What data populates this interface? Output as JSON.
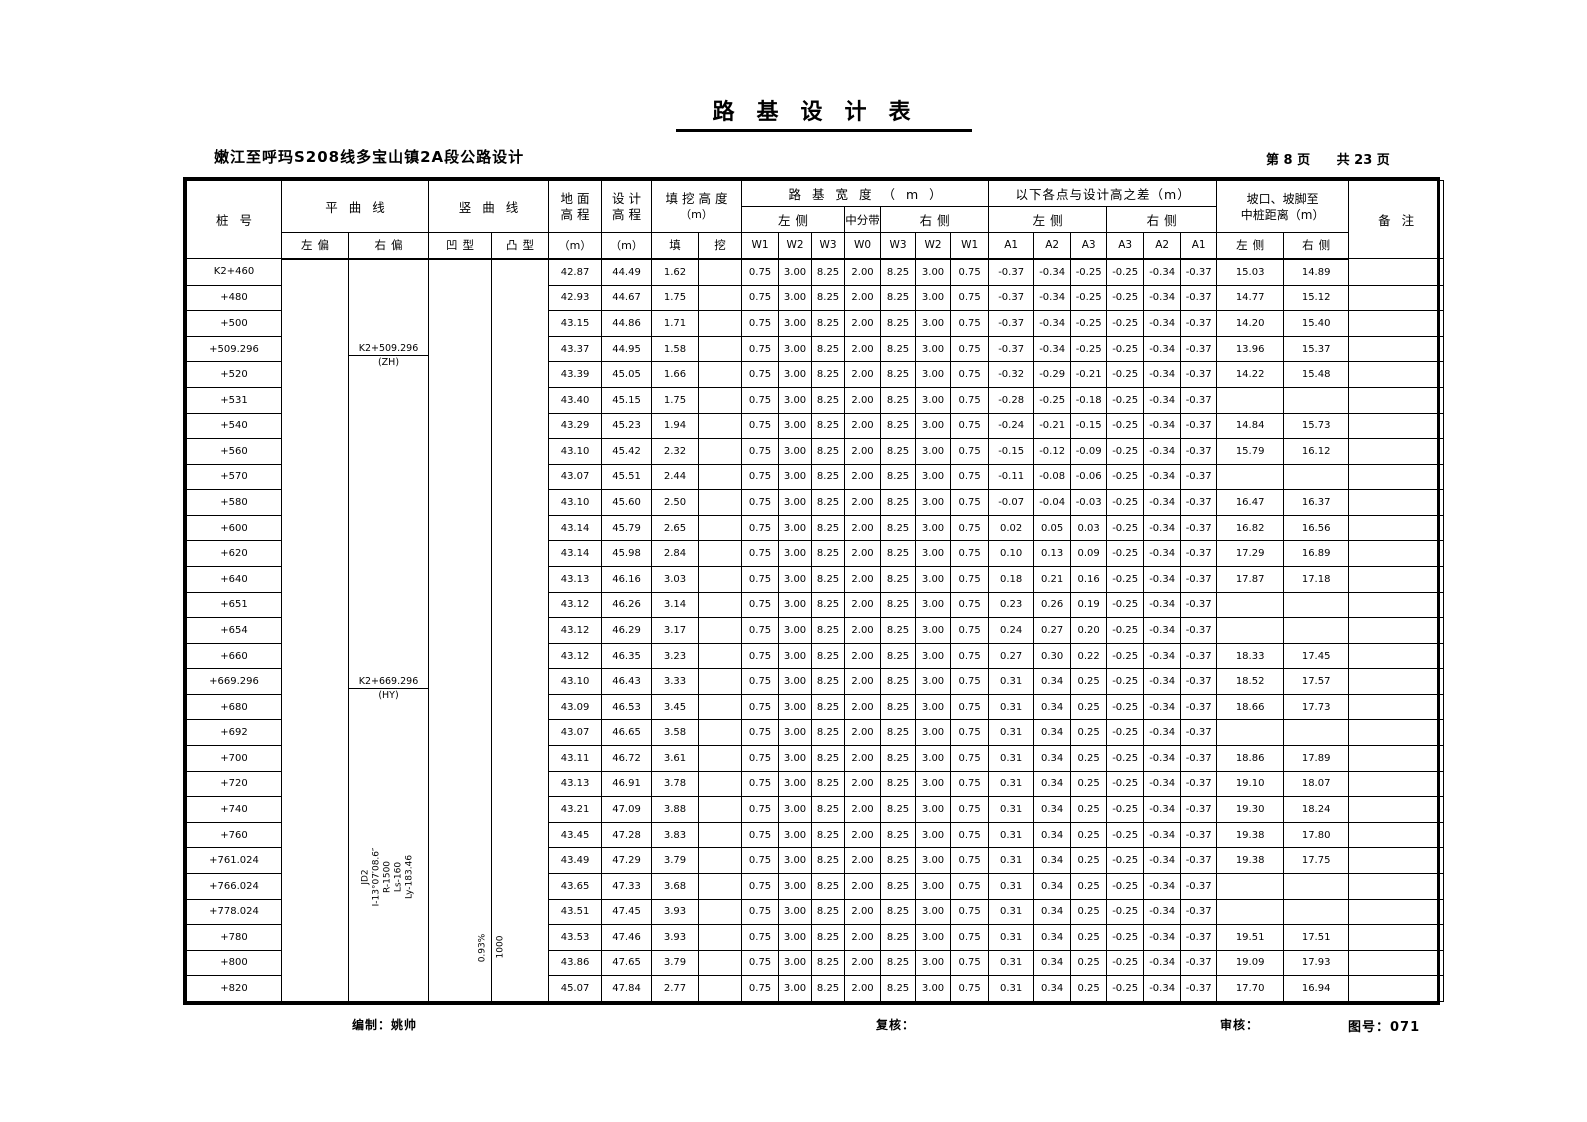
{
  "title": "路基设计表",
  "subtitle": "嫩江至呼玛S208线多宝山镇2A段公路设计",
  "page_info": {
    "current": "第 8 页",
    "total": "共 23 页"
  },
  "table": {
    "header": {
      "stake": "桩号",
      "horizontal_curve": "平曲线",
      "left_deflection": "左偏",
      "right_deflection": "右偏",
      "vertical_curve": "竖曲线",
      "concave": "凹型",
      "convex": "凸型",
      "ground_line1": "地面",
      "ground_line2": "高程",
      "design_line1": "设计",
      "design_line2": "高程",
      "unit_m": "（m）",
      "cutfill_line1": "填挖高度",
      "cutfill_line2": "（m）",
      "fill": "填",
      "cut": "挖",
      "roadbed_width": "路基宽度（m）",
      "left_side": "左侧",
      "median": "中分带",
      "right_side": "右侧",
      "w_labels": [
        "W1",
        "W2",
        "W3",
        "W0",
        "W3",
        "W2",
        "W1"
      ],
      "diff_title": "以下各点与设计高之差（m）",
      "a_labels": [
        "A1",
        "A2",
        "A3",
        "A3",
        "A2",
        "A1"
      ],
      "slope_line1": "坡口、坡脚至",
      "slope_line2": "中桩距离（m）",
      "dist_left": "左侧",
      "dist_right": "右侧",
      "remarks": "备注"
    },
    "w_all_rows": [
      "0.75",
      "3.00",
      "8.25",
      "2.00",
      "8.25",
      "3.00",
      "0.75"
    ],
    "rows": [
      {
        "stake": "K2+460",
        "ground": "42.87",
        "design": "44.49",
        "fill": "1.62",
        "cut": "",
        "a": [
          "-0.37",
          "-0.34",
          "-0.25",
          "-0.25",
          "-0.34",
          "-0.37"
        ],
        "dl": "15.03",
        "dr": "14.89"
      },
      {
        "stake": "+480",
        "ground": "42.93",
        "design": "44.67",
        "fill": "1.75",
        "cut": "",
        "a": [
          "-0.37",
          "-0.34",
          "-0.25",
          "-0.25",
          "-0.34",
          "-0.37"
        ],
        "dl": "14.77",
        "dr": "15.12"
      },
      {
        "stake": "+500",
        "ground": "43.15",
        "design": "44.86",
        "fill": "1.71",
        "cut": "",
        "a": [
          "-0.37",
          "-0.34",
          "-0.25",
          "-0.25",
          "-0.34",
          "-0.37"
        ],
        "dl": "14.20",
        "dr": "15.40"
      },
      {
        "stake": "+509.296",
        "ground": "43.37",
        "design": "44.95",
        "fill": "1.58",
        "cut": "",
        "a": [
          "-0.37",
          "-0.34",
          "-0.25",
          "-0.25",
          "-0.34",
          "-0.37"
        ],
        "dl": "13.96",
        "dr": "15.37"
      },
      {
        "stake": "+520",
        "ground": "43.39",
        "design": "45.05",
        "fill": "1.66",
        "cut": "",
        "a": [
          "-0.32",
          "-0.29",
          "-0.21",
          "-0.25",
          "-0.34",
          "-0.37"
        ],
        "dl": "14.22",
        "dr": "15.48"
      },
      {
        "stake": "+531",
        "ground": "43.40",
        "design": "45.15",
        "fill": "1.75",
        "cut": "",
        "a": [
          "-0.28",
          "-0.25",
          "-0.18",
          "-0.25",
          "-0.34",
          "-0.37"
        ],
        "dl": "",
        "dr": ""
      },
      {
        "stake": "+540",
        "ground": "43.29",
        "design": "45.23",
        "fill": "1.94",
        "cut": "",
        "a": [
          "-0.24",
          "-0.21",
          "-0.15",
          "-0.25",
          "-0.34",
          "-0.37"
        ],
        "dl": "14.84",
        "dr": "15.73"
      },
      {
        "stake": "+560",
        "ground": "43.10",
        "design": "45.42",
        "fill": "2.32",
        "cut": "",
        "a": [
          "-0.15",
          "-0.12",
          "-0.09",
          "-0.25",
          "-0.34",
          "-0.37"
        ],
        "dl": "15.79",
        "dr": "16.12"
      },
      {
        "stake": "+570",
        "ground": "43.07",
        "design": "45.51",
        "fill": "2.44",
        "cut": "",
        "a": [
          "-0.11",
          "-0.08",
          "-0.06",
          "-0.25",
          "-0.34",
          "-0.37"
        ],
        "dl": "",
        "dr": ""
      },
      {
        "stake": "+580",
        "ground": "43.10",
        "design": "45.60",
        "fill": "2.50",
        "cut": "",
        "a": [
          "-0.07",
          "-0.04",
          "-0.03",
          "-0.25",
          "-0.34",
          "-0.37"
        ],
        "dl": "16.47",
        "dr": "16.37"
      },
      {
        "stake": "+600",
        "ground": "43.14",
        "design": "45.79",
        "fill": "2.65",
        "cut": "",
        "a": [
          "0.02",
          "0.05",
          "0.03",
          "-0.25",
          "-0.34",
          "-0.37"
        ],
        "dl": "16.82",
        "dr": "16.56"
      },
      {
        "stake": "+620",
        "ground": "43.14",
        "design": "45.98",
        "fill": "2.84",
        "cut": "",
        "a": [
          "0.10",
          "0.13",
          "0.09",
          "-0.25",
          "-0.34",
          "-0.37"
        ],
        "dl": "17.29",
        "dr": "16.89"
      },
      {
        "stake": "+640",
        "ground": "43.13",
        "design": "46.16",
        "fill": "3.03",
        "cut": "",
        "a": [
          "0.18",
          "0.21",
          "0.16",
          "-0.25",
          "-0.34",
          "-0.37"
        ],
        "dl": "17.87",
        "dr": "17.18"
      },
      {
        "stake": "+651",
        "ground": "43.12",
        "design": "46.26",
        "fill": "3.14",
        "cut": "",
        "a": [
          "0.23",
          "0.26",
          "0.19",
          "-0.25",
          "-0.34",
          "-0.37"
        ],
        "dl": "",
        "dr": ""
      },
      {
        "stake": "+654",
        "ground": "43.12",
        "design": "46.29",
        "fill": "3.17",
        "cut": "",
        "a": [
          "0.24",
          "0.27",
          "0.20",
          "-0.25",
          "-0.34",
          "-0.37"
        ],
        "dl": "",
        "dr": ""
      },
      {
        "stake": "+660",
        "ground": "43.12",
        "design": "46.35",
        "fill": "3.23",
        "cut": "",
        "a": [
          "0.27",
          "0.30",
          "0.22",
          "-0.25",
          "-0.34",
          "-0.37"
        ],
        "dl": "18.33",
        "dr": "17.45"
      },
      {
        "stake": "+669.296",
        "ground": "43.10",
        "design": "46.43",
        "fill": "3.33",
        "cut": "",
        "a": [
          "0.31",
          "0.34",
          "0.25",
          "-0.25",
          "-0.34",
          "-0.37"
        ],
        "dl": "18.52",
        "dr": "17.57"
      },
      {
        "stake": "+680",
        "ground": "43.09",
        "design": "46.53",
        "fill": "3.45",
        "cut": "",
        "a": [
          "0.31",
          "0.34",
          "0.25",
          "-0.25",
          "-0.34",
          "-0.37"
        ],
        "dl": "18.66",
        "dr": "17.73"
      },
      {
        "stake": "+692",
        "ground": "43.07",
        "design": "46.65",
        "fill": "3.58",
        "cut": "",
        "a": [
          "0.31",
          "0.34",
          "0.25",
          "-0.25",
          "-0.34",
          "-0.37"
        ],
        "dl": "",
        "dr": ""
      },
      {
        "stake": "+700",
        "ground": "43.11",
        "design": "46.72",
        "fill": "3.61",
        "cut": "",
        "a": [
          "0.31",
          "0.34",
          "0.25",
          "-0.25",
          "-0.34",
          "-0.37"
        ],
        "dl": "18.86",
        "dr": "17.89"
      },
      {
        "stake": "+720",
        "ground": "43.13",
        "design": "46.91",
        "fill": "3.78",
        "cut": "",
        "a": [
          "0.31",
          "0.34",
          "0.25",
          "-0.25",
          "-0.34",
          "-0.37"
        ],
        "dl": "19.10",
        "dr": "18.07"
      },
      {
        "stake": "+740",
        "ground": "43.21",
        "design": "47.09",
        "fill": "3.88",
        "cut": "",
        "a": [
          "0.31",
          "0.34",
          "0.25",
          "-0.25",
          "-0.34",
          "-0.37"
        ],
        "dl": "19.30",
        "dr": "18.24"
      },
      {
        "stake": "+760",
        "ground": "43.45",
        "design": "47.28",
        "fill": "3.83",
        "cut": "",
        "a": [
          "0.31",
          "0.34",
          "0.25",
          "-0.25",
          "-0.34",
          "-0.37"
        ],
        "dl": "19.38",
        "dr": "17.80"
      },
      {
        "stake": "+761.024",
        "ground": "43.49",
        "design": "47.29",
        "fill": "3.79",
        "cut": "",
        "a": [
          "0.31",
          "0.34",
          "0.25",
          "-0.25",
          "-0.34",
          "-0.37"
        ],
        "dl": "19.38",
        "dr": "17.75"
      },
      {
        "stake": "+766.024",
        "ground": "43.65",
        "design": "47.33",
        "fill": "3.68",
        "cut": "",
        "a": [
          "0.31",
          "0.34",
          "0.25",
          "-0.25",
          "-0.34",
          "-0.37"
        ],
        "dl": "",
        "dr": ""
      },
      {
        "stake": "+778.024",
        "ground": "43.51",
        "design": "47.45",
        "fill": "3.93",
        "cut": "",
        "a": [
          "0.31",
          "0.34",
          "0.25",
          "-0.25",
          "-0.34",
          "-0.37"
        ],
        "dl": "",
        "dr": ""
      },
      {
        "stake": "+780",
        "ground": "43.53",
        "design": "47.46",
        "fill": "3.93",
        "cut": "",
        "a": [
          "0.31",
          "0.34",
          "0.25",
          "-0.25",
          "-0.34",
          "-0.37"
        ],
        "dl": "19.51",
        "dr": "17.51"
      },
      {
        "stake": "+800",
        "ground": "43.86",
        "design": "47.65",
        "fill": "3.79",
        "cut": "",
        "a": [
          "0.31",
          "0.34",
          "0.25",
          "-0.25",
          "-0.34",
          "-0.37"
        ],
        "dl": "19.09",
        "dr": "17.93"
      },
      {
        "stake": "+820",
        "ground": "45.07",
        "design": "47.84",
        "fill": "2.77",
        "cut": "",
        "a": [
          "0.31",
          "0.34",
          "0.25",
          "-0.25",
          "-0.34",
          "-0.37"
        ],
        "dl": "17.70",
        "dr": "16.94"
      }
    ]
  },
  "annotations": {
    "zh": {
      "station": "K2+509.296",
      "label": "(ZH)"
    },
    "hy": {
      "station": "K2+669.296",
      "label": "(HY)"
    },
    "jd": [
      "JD2",
      "I-13°07′08.6″",
      "R-1500",
      "Ls-160",
      "Ly-183.46"
    ],
    "grade": "0.93%",
    "vcurve": "1000"
  },
  "footer": {
    "prepared": "编制：姚帅",
    "checked": "复核：",
    "reviewed": "审核：",
    "drawing_no": "图号：071"
  }
}
